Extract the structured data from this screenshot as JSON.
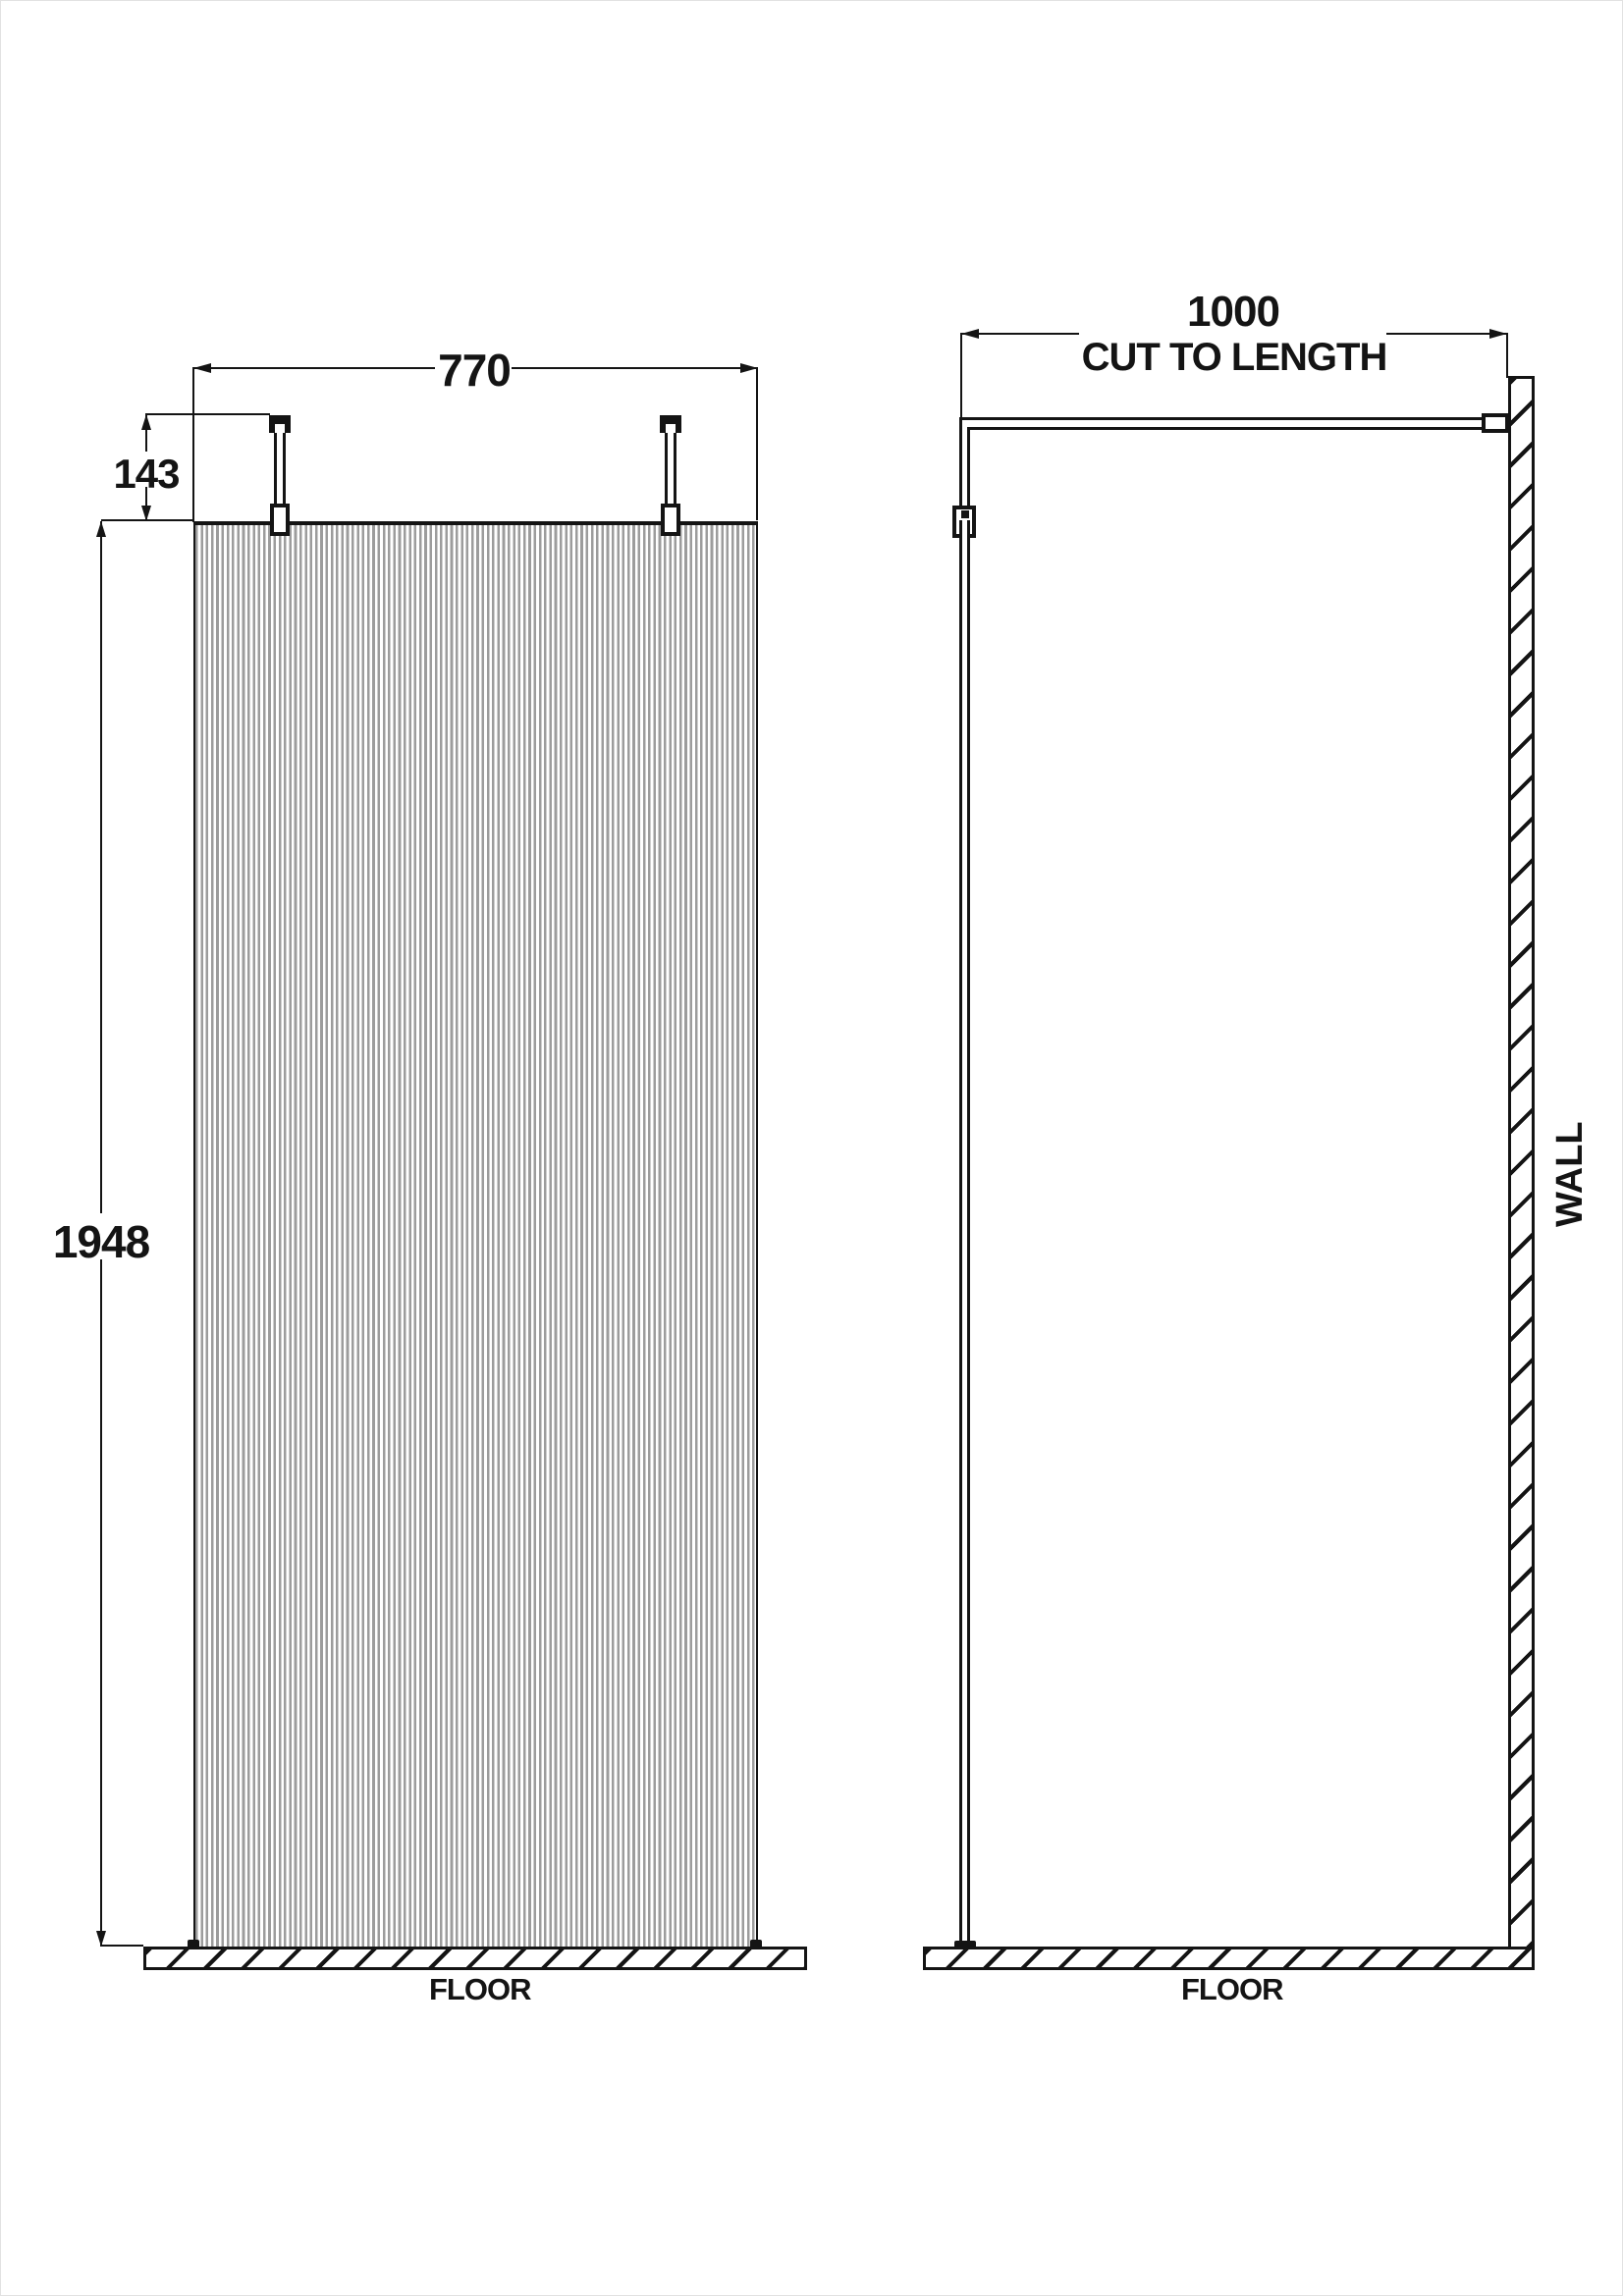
{
  "diagram": {
    "title_hint": "wetroom-screen-technical-drawing",
    "front_view": {
      "width_dim": "770",
      "bracket_height_dim": "143",
      "panel_height_dim": "1948",
      "floor_label": "FLOOR"
    },
    "side_view": {
      "arm_length_dim": "1000",
      "arm_note": "CUT TO LENGTH",
      "wall_label": "WALL",
      "floor_label": "FLOOR"
    },
    "colors": {
      "ink": "#141414",
      "flute_stripe": "#9c9c9c",
      "background": "#ffffff"
    }
  }
}
